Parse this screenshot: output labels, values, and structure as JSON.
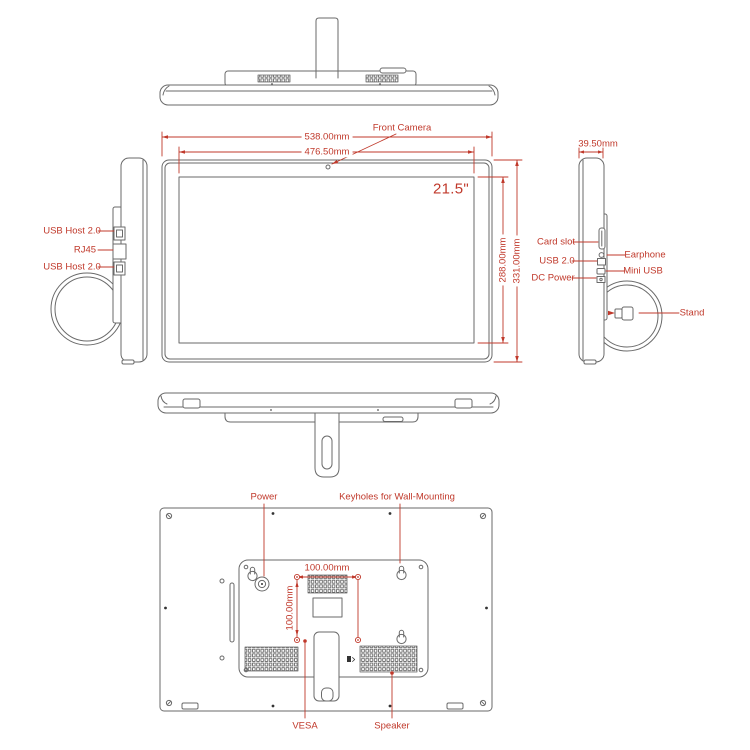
{
  "colors": {
    "line": "#6a6a6a",
    "accent": "#c0392b"
  },
  "front": {
    "camera_label": "Front Camera",
    "width_outer": "538.00mm",
    "width_screen": "476.50mm",
    "height_screen": "288.00mm",
    "height_outer": "331.00mm",
    "screen_size": "21.5\""
  },
  "left_side": {
    "usb_top": "USB Host 2.0",
    "rj45": "RJ45",
    "usb_bottom": "USB Host 2.0"
  },
  "right_side": {
    "depth": "39.50mm",
    "card_slot": "Card slot",
    "usb": "USB 2.0",
    "dc_power": "DC Power",
    "earphone": "Earphone",
    "mini_usb": "Mini USB",
    "stand": "Stand"
  },
  "back": {
    "power": "Power",
    "keyholes": "Keyholes for Wall-Mounting",
    "vesa_width": "100.00mm",
    "vesa_height": "100.00mm",
    "vesa": "VESA",
    "speaker": "Speaker"
  }
}
